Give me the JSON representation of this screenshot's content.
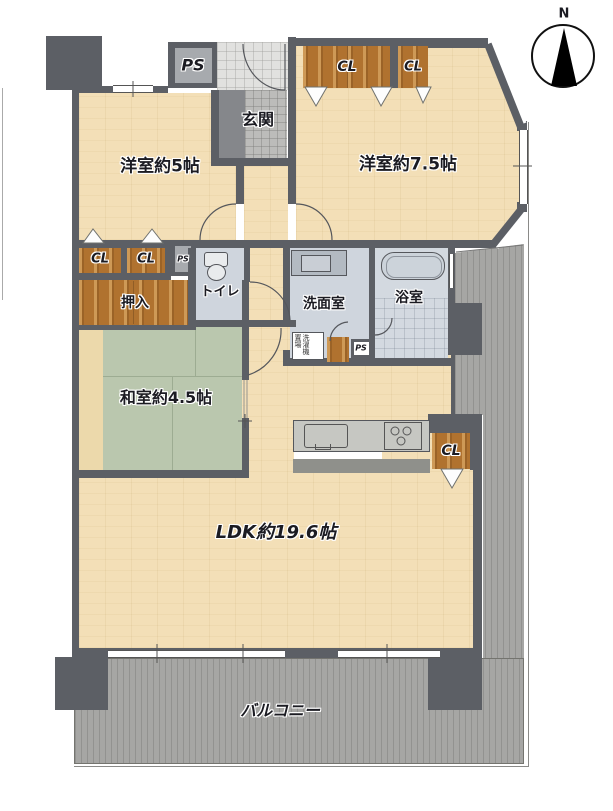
{
  "plan": {
    "compass": {
      "label": "N"
    },
    "rooms": {
      "west5": "洋室約5帖",
      "west75": "洋室約7.5帖",
      "washitsu": "和室約4.5帖",
      "ldk": "LDK約19.6帖",
      "genkan": "玄関",
      "toilet": "トイレ",
      "washroom": "洗面室",
      "bathroom": "浴室",
      "balcony": "バルコニー",
      "oshiire": "押入"
    },
    "labels": {
      "closet": "CL",
      "pipe_space": "PS",
      "laundry": "洗濯機置場"
    },
    "colors": {
      "wall": "#5c5f65",
      "wood_floor": "#f3dfb7",
      "tatami": "#bac7ae",
      "wet_room": "#cfd5dd",
      "closet_wood": "#b0722f",
      "balcony_deck": "#a6a6a4",
      "genkan_tile": "#e1e1df",
      "label_text": "#1b1b22"
    }
  }
}
